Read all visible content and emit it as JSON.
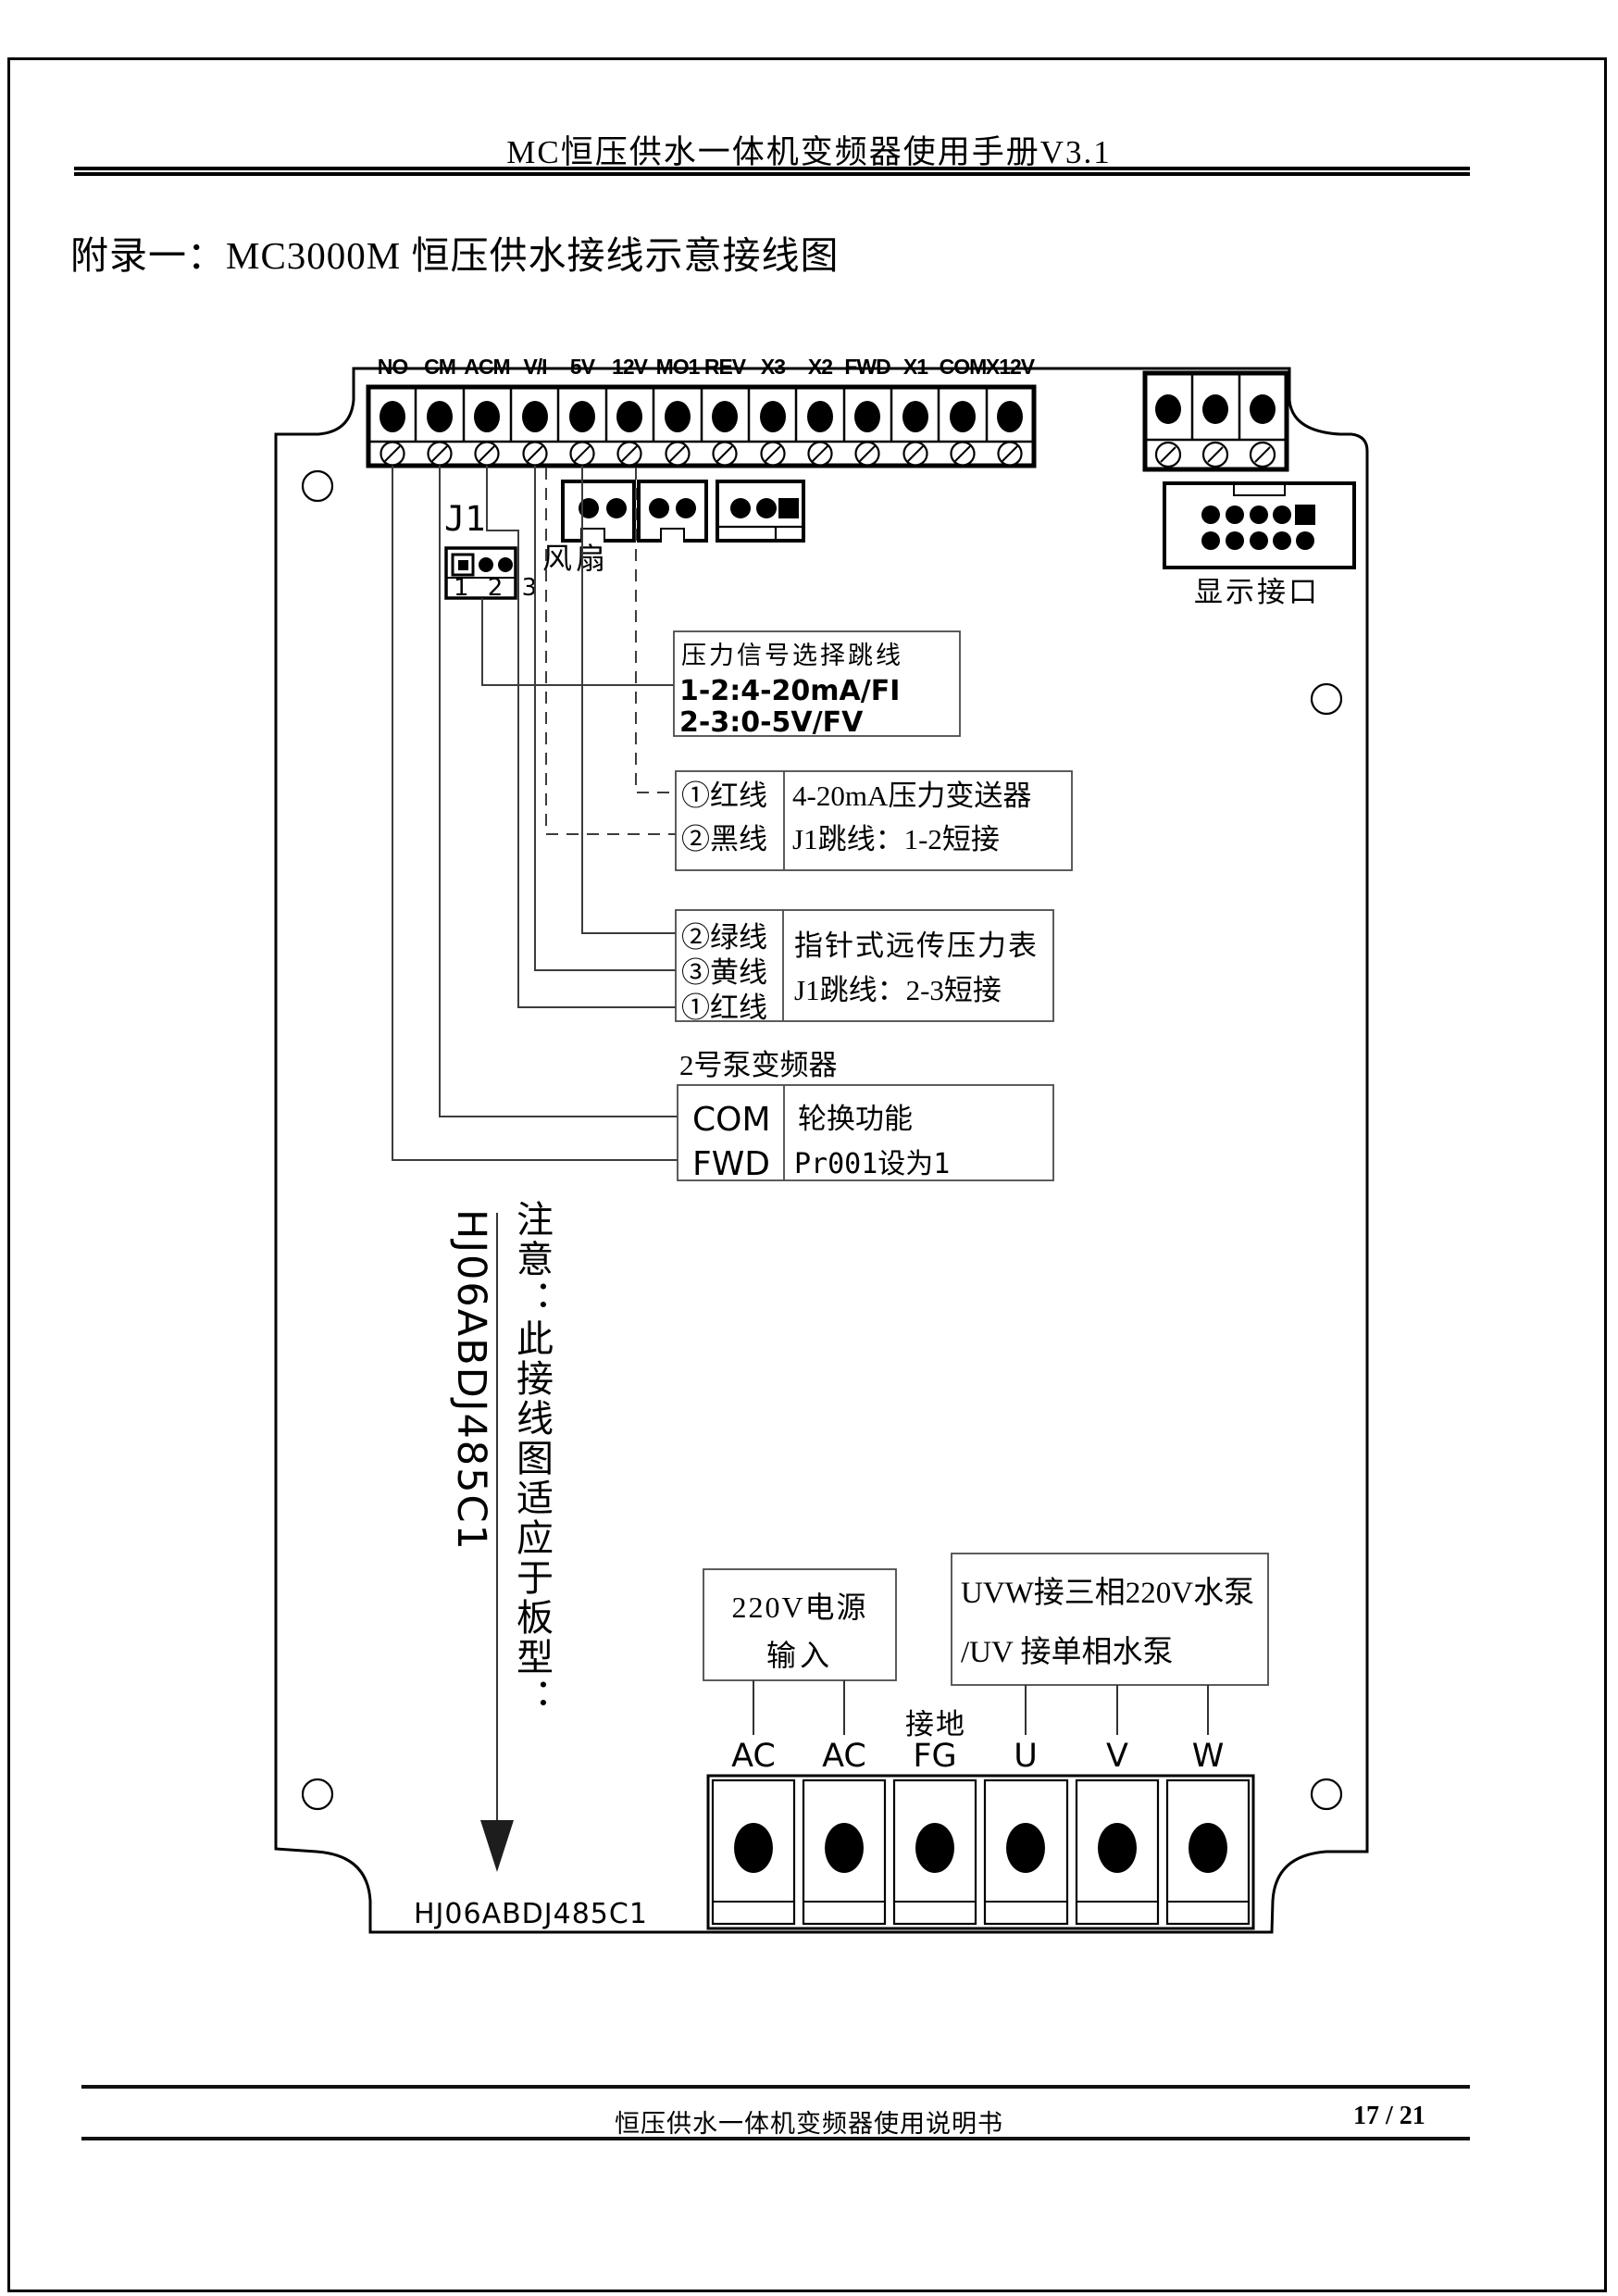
{
  "page": {
    "header_title": "MC恒压供水一体机变频器使用手册V3.1",
    "appendix_title": "附录一：MC3000M 恒压供水接线示意接线图",
    "footer_text": "恒压供水一体机变频器使用说明书",
    "page_number": "17 / 21"
  },
  "diagram": {
    "main_terminals": [
      "NO",
      "CM",
      "ACM",
      "V/I",
      "5V",
      "12V",
      "MO1",
      "REV",
      "X3",
      "X2",
      "FWD",
      "X1",
      "COM",
      "X12V"
    ],
    "j1": {
      "label": "J1",
      "pins": "1 2 3"
    },
    "fan_label": "风扇",
    "display_port_label": "显示接口",
    "pressure_jumper_box": {
      "line1": "压力信号选择跳线",
      "line2": "1-2:4-20mA/FI",
      "line3": "2-3:0-5V/FV"
    },
    "transducer_box": {
      "wire1": "①红线",
      "wire2": "②黑线",
      "desc1": "4-20mA压力变送器",
      "desc2": "J1跳线：1-2短接"
    },
    "gauge_box": {
      "wire1": "②绿线",
      "wire2": "③黄线",
      "wire3": "①红线",
      "desc1": "指针式远传压力表",
      "desc2": "J1跳线：2-3短接"
    },
    "pump2_title": "2号泵变频器",
    "pump2_box": {
      "t1": "COM",
      "t2": "FWD",
      "desc1": "轮换功能",
      "desc2": "Pr001设为1"
    },
    "note_vertical": "注意：此接线图适应于板型：",
    "board_model_vertical": "HJ06ABDJ485C1",
    "board_model_bottom": "HJ06ABDJ485C1",
    "power_box": {
      "line1": "220V电源",
      "line2": "输入"
    },
    "pump_box": {
      "line1": "UVW接三相220V水泵",
      "line2": "/UV 接单相水泵"
    },
    "ground_label": "接地",
    "power_terminals": [
      "AC",
      "AC",
      "FG",
      "U",
      "V",
      "W"
    ]
  }
}
